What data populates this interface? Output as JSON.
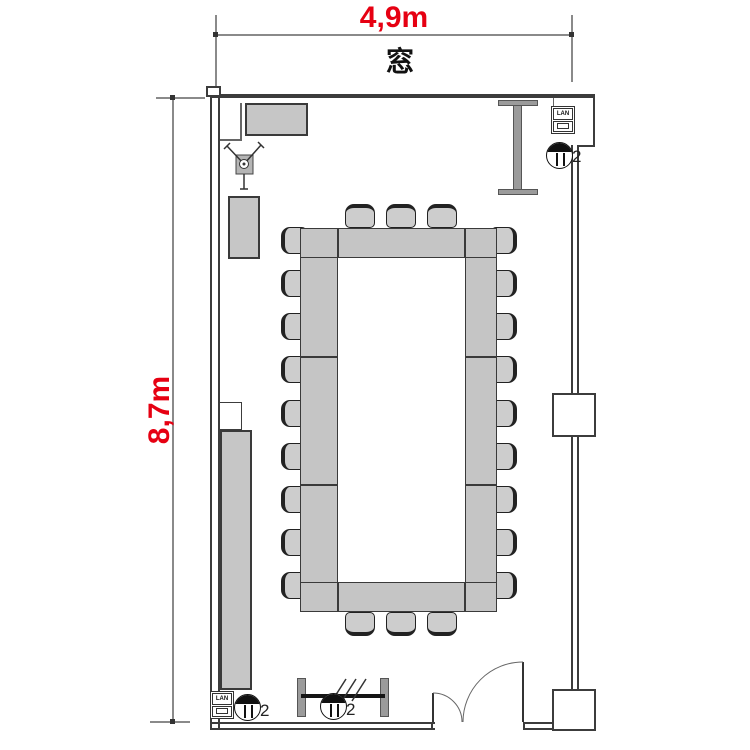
{
  "page": {
    "type": "floor-plan",
    "subject": "meeting room with closed-square table layout"
  },
  "labels": {
    "width": "4,9m",
    "height": "8,7m",
    "window": "窓"
  },
  "outlets": [
    {
      "label": "2",
      "location": "top-right"
    },
    {
      "label": "2",
      "location": "bottom-left"
    },
    {
      "label": "2",
      "location": "bottom-center"
    }
  ],
  "wall_plates": [
    {
      "label": "LAN",
      "location": "top-right"
    },
    {
      "label": "LAN",
      "location": "bottom-left"
    }
  ],
  "table": {
    "layout": "closed-rectangle",
    "seats": {
      "top": 3,
      "bottom": 3,
      "left": 9,
      "right": 9
    },
    "total_seats": 24
  },
  "furniture": [
    "top-cabinet",
    "side-cabinet-upper",
    "side-cabinet-long",
    "projector-tripod",
    "screen-board-top",
    "partition-board-bottom",
    "entrance-double-door"
  ],
  "colors": {
    "dimension_text": "#e60012",
    "wall_line": "#3c3c3c",
    "furniture_fill": "#c6c6c6",
    "chair_fill": "#cdcdcd"
  }
}
